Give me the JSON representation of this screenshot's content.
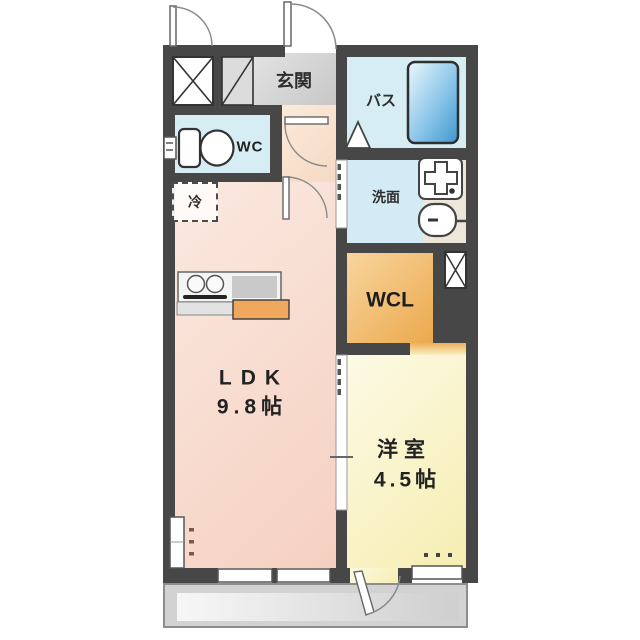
{
  "plan": {
    "type": "floorplan",
    "rooms": {
      "entrance": {
        "label": "玄関"
      },
      "bath": {
        "label": "バス"
      },
      "toilet": {
        "label": "WC"
      },
      "washroom": {
        "label": "洗面"
      },
      "refrigerator_space": {
        "label": "冷"
      },
      "walk_in_closet": {
        "label": "WCL"
      },
      "ldk": {
        "label": "LDK",
        "size": "9.8帖"
      },
      "western_room": {
        "label": "洋室",
        "size": "4.5帖"
      }
    },
    "icons": {
      "bathtub": "bathtub-icon",
      "toilet": "toilet-icon",
      "washing_machine": "washing-machine-pan-icon",
      "sink": "sink-icon",
      "stove": "stove-burners-icon",
      "pipe_space": "x-box-icon",
      "shoe_cabinet": "diagonal-box-icon",
      "door_swing": "door-arc-icon",
      "sliding_door": "sliding-door-icon",
      "folding_bath_door": "triangle-door-icon"
    },
    "colors": {
      "wall": "#474747",
      "water_rooms_blue": "#d7edf4",
      "entrance_gray": "#d0d0d0",
      "ldk_pink": "#f6d4c5",
      "closet_orange": "#efb364",
      "western_room_yellow": "#f9f2c8",
      "bathtub_blue": "#55a9dd",
      "balcony_gray": "#d2d2d2",
      "kitchen_counter_orange": "#f0a85c"
    }
  }
}
